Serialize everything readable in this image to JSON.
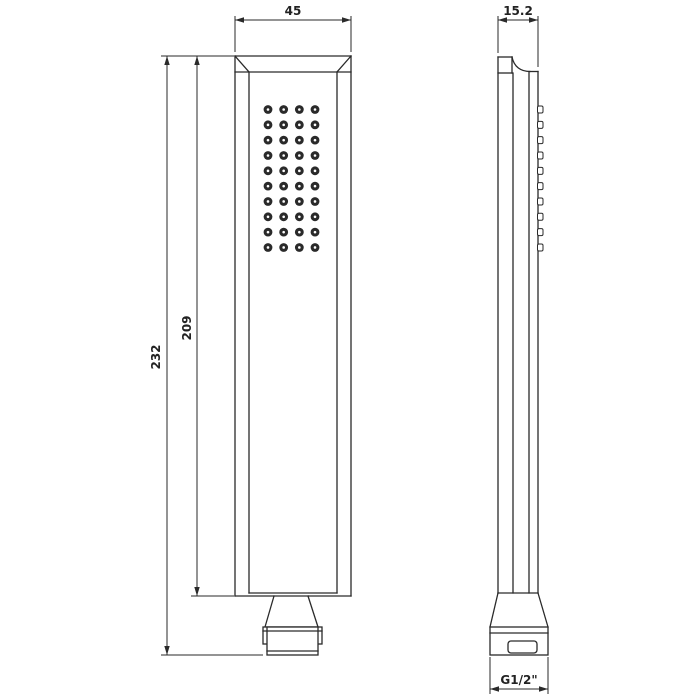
{
  "drawing": {
    "type": "technical-orthographic-drawing",
    "subject": "handheld-shower-head",
    "views": [
      "front",
      "side"
    ],
    "line_color": "#2a2a2a",
    "background_color": "#ffffff",
    "dimensions": {
      "front_width": "45",
      "side_depth": "15.2",
      "overall_height": "232",
      "body_height": "209",
      "connector_thread": "G1/2\""
    },
    "nozzle_grid": {
      "columns": 4,
      "rows": 10,
      "start_x": 268,
      "start_y": 109.5,
      "col_spacing": 15.67,
      "row_spacing": 15.33,
      "dot_radius": 4.4,
      "center_radius": 1.3
    },
    "side_nozzles": {
      "count": 10,
      "x": 537.5,
      "width": 5.5,
      "height": 7,
      "start_y": 109.5,
      "spacing": 15.33,
      "corner_radius": 1.5
    }
  }
}
